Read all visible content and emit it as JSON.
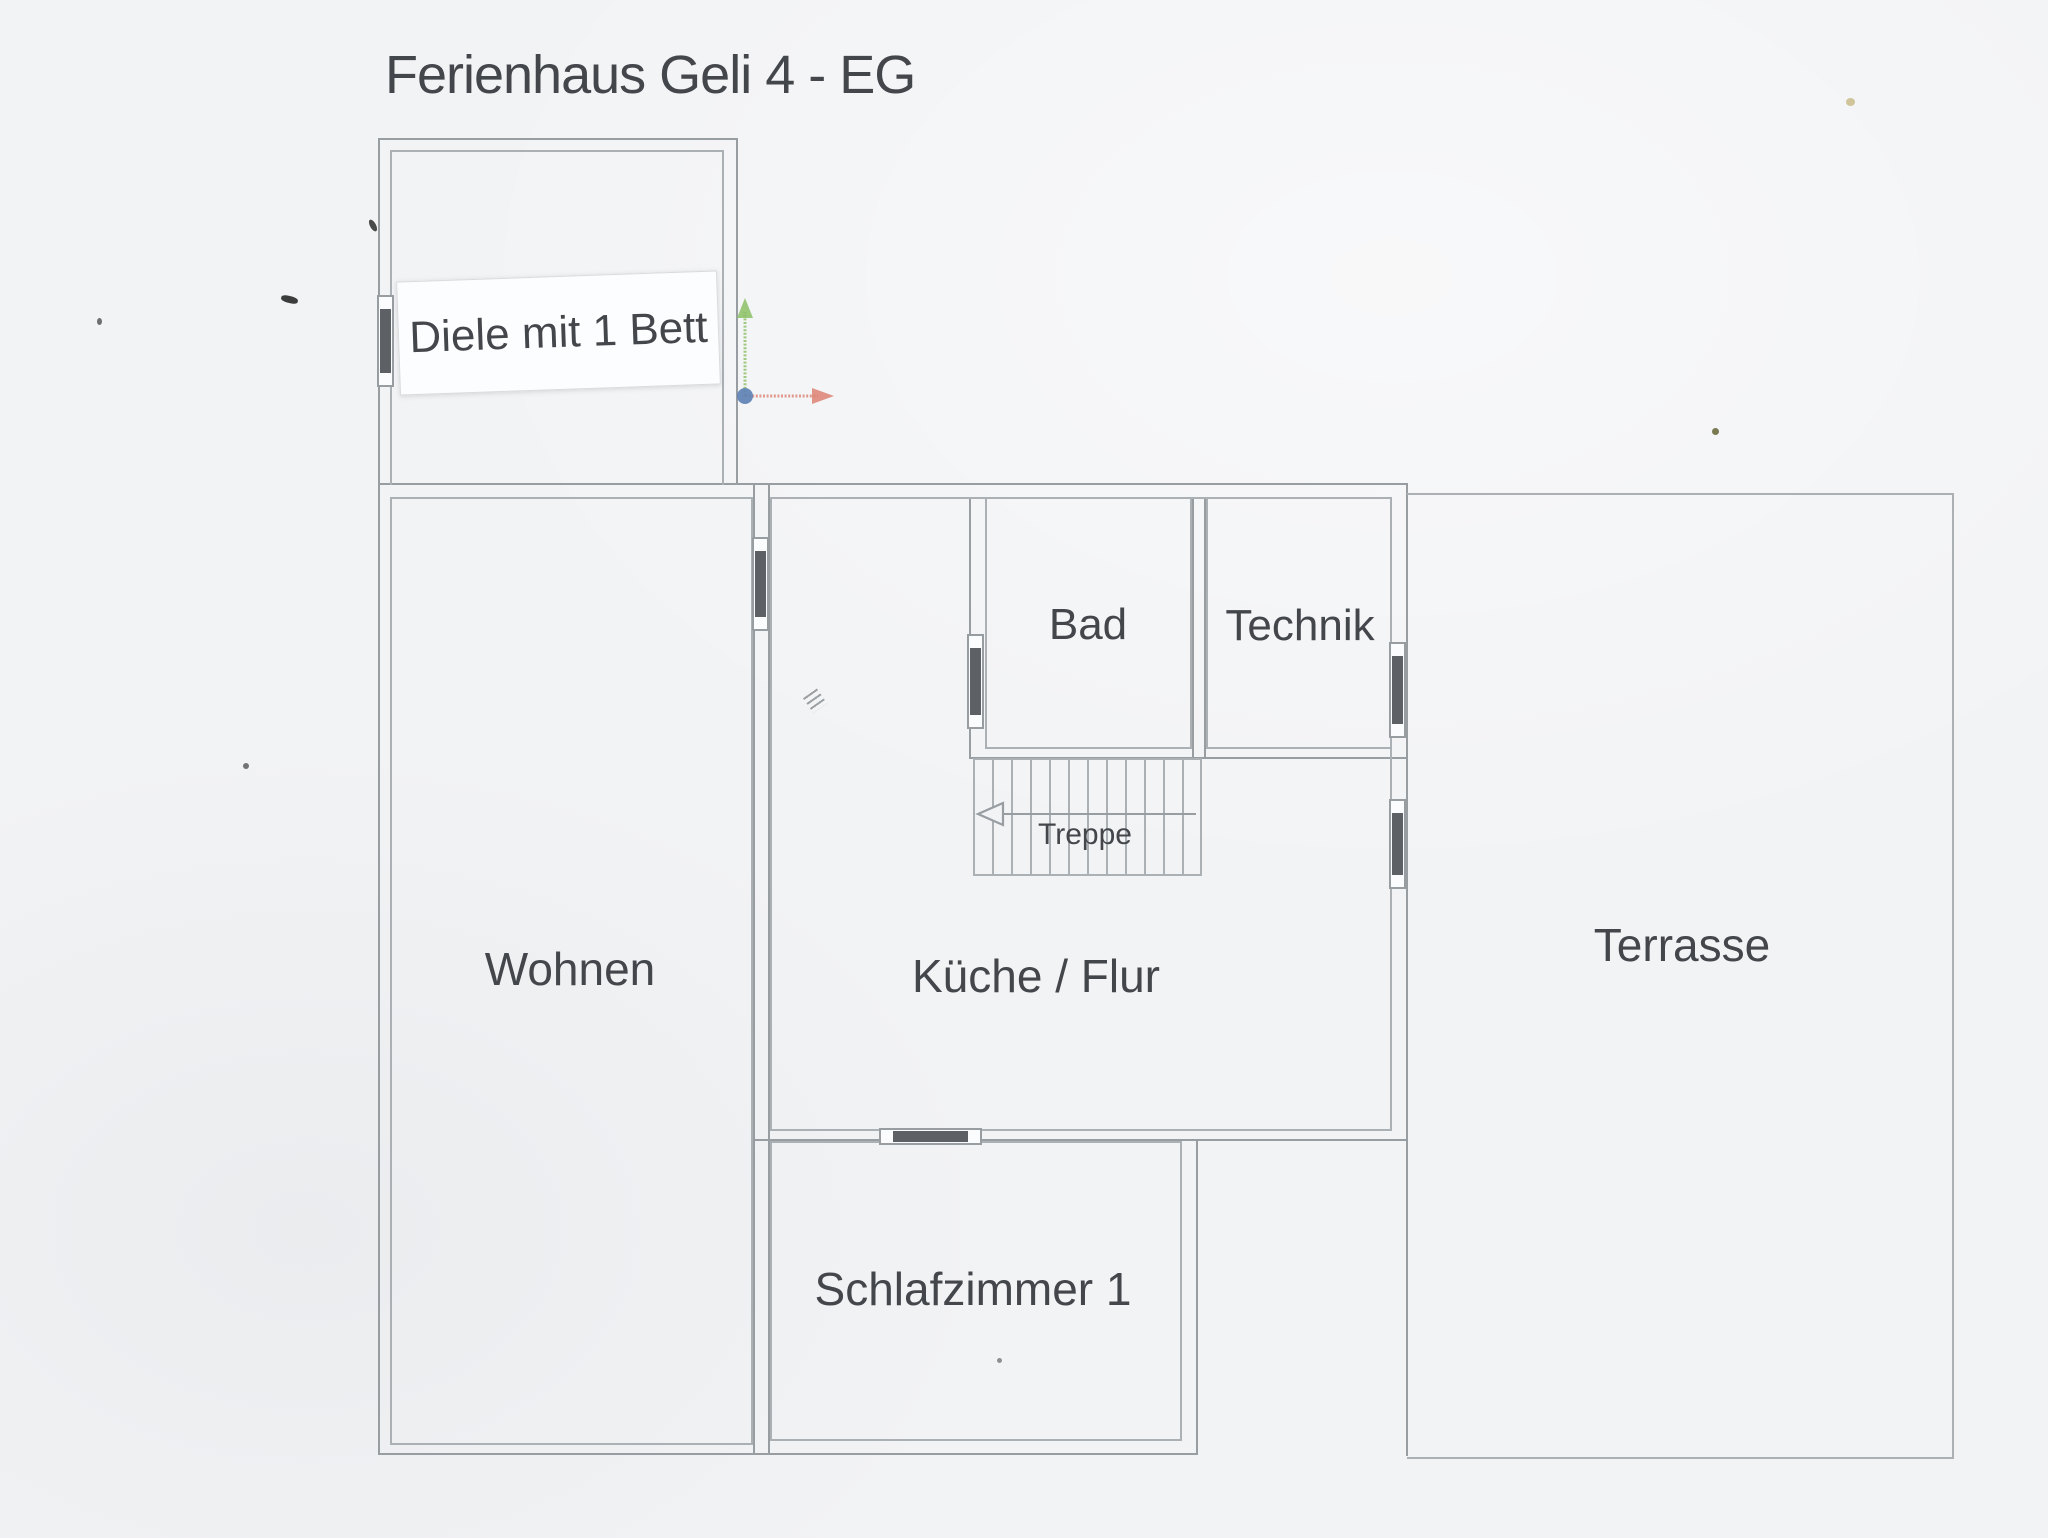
{
  "title": "Ferienhaus Geli 4 - EG",
  "rooms": {
    "diele": {
      "label": "Diele mit 1 Bett"
    },
    "wohnen": {
      "label": "Wohnen"
    },
    "kueche": {
      "label": "Küche / Flur"
    },
    "bad": {
      "label": "Bad"
    },
    "technik": {
      "label": "Technik"
    },
    "treppe": {
      "label": "Treppe"
    },
    "terrasse": {
      "label": "Terrasse"
    },
    "schlafzimmer": {
      "label": "Schlafzimmer 1"
    }
  },
  "icons": {
    "axis": "coordinate-axes-icon",
    "stairs_direction": "stairs-direction-left-arrow-icon",
    "windows": "window-door-symbol"
  },
  "colors": {
    "paper": "#f2f3f5",
    "wall": "#989da2",
    "wall-light": "#abb0b5",
    "text": "#43464b",
    "door": "#5d6165",
    "win-fill": "#fbfcfd",
    "label-bg": "#fcfdfe",
    "axis-green": "#8bbf65",
    "axis-red": "#dd8174",
    "axis-blue": "#5c7fb4"
  }
}
